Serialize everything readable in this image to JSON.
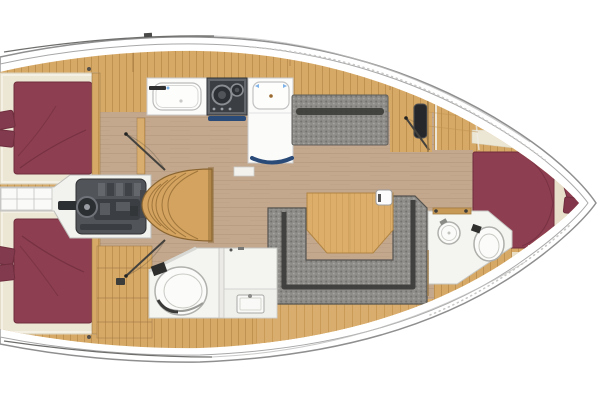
{
  "image": {
    "description": "Top-down interior layout plan of a sailing yacht: two aft double cabins with maroon berths, central engine compartment and companionway steps, galley with sink, stove and fridge, salon with U-shaped settee and table, side settee, aft head with shower, forward en-suite head, and forward cabin with V-berth and pillows",
    "width": 600,
    "height": 400
  },
  "palette": {
    "background": "#ffffff",
    "hull_fill": "#ffffff",
    "hull_outline": "#8f8f8f",
    "deck_line": "#a8a8a8",
    "deck_wood": "#d7a966",
    "deck_wood_line": "#bf9251",
    "floor_wood": "#c3a88d",
    "floor_line": "#a88d72",
    "oak_plank": "#d9ad6d",
    "oak_plank_line": "#c3934f",
    "berth_maroon": "#8d3e50",
    "berth_seam": "#6f2e3e",
    "pillow_maroon": "#823a4e",
    "bedding_cream": "#ece6d4",
    "bedding_shadow": "#d9d2bd",
    "vberth_cream": "#f2eee2",
    "headboard_cream": "#e7dfca",
    "cushion_gray": "#8f8d89",
    "cushion_speck": "#757370",
    "cushion_light": "#a6a4a0",
    "cushion_dark": "#3b3b39",
    "fixture_white": "#f4f4f1",
    "fixture_line": "#c6c6c2",
    "porcelain": "#fbfbf9",
    "porcelain_line": "#b0b0ad",
    "appliance_dark": "#3b3f44",
    "appliance_frame": "#63676c",
    "engine_gray": "#515458",
    "engine_dark": "#2c2f32",
    "navy_accent": "#2a4a78",
    "table_wood": "#dcae69",
    "table_edge": "#b08443",
    "stair_wood": "#d3a35f",
    "stair_line": "#a0763c",
    "wall_wood": "#9c7948",
    "hardware_dark": "#3c3c3a",
    "blue_mark": "#7fb3e8"
  },
  "regions": {
    "hull": {
      "label": "Boat hull"
    },
    "aft_cabin_port": {
      "label": "Aft cabin (port)"
    },
    "aft_cabin_starboard": {
      "label": "Aft cabin (starboard)"
    },
    "engine_compartment": {
      "label": "Engine compartment"
    },
    "companionway": {
      "label": "Companionway steps"
    },
    "galley": {
      "label": "Galley"
    },
    "salon": {
      "label": "Salon"
    },
    "side_settee": {
      "label": "Side settee"
    },
    "u_settee": {
      "label": "U-shaped settee"
    },
    "salon_table": {
      "label": "Salon table"
    },
    "aft_head": {
      "label": "Aft head with shower"
    },
    "forward_head": {
      "label": "Forward en-suite head"
    },
    "forward_cabin": {
      "label": "Forward cabin"
    },
    "v_berth": {
      "label": "V-berth cushions"
    }
  }
}
